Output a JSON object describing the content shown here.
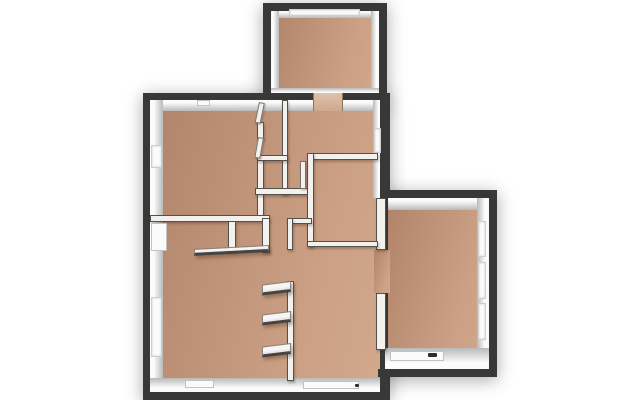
{
  "scene": {
    "description": "3D top-down architectural floor plan render, empty rooms, no text labels",
    "canvas": {
      "width": 640,
      "height": 400
    },
    "colors": {
      "background": "#ffffff",
      "exterior_wall": "#383838",
      "wall_face_highlight": "#fbfbfb",
      "wall_face_shadow": "#b9b9b9",
      "floor_dark": "#b1846a",
      "floor_light": "#cba084",
      "window_recess": "#fbfbfb",
      "interior_wall": "#f3f1ee",
      "wall_edge": "#55504a"
    }
  },
  "plan": {
    "footprints": [
      {
        "name": "footprint-top-room",
        "x": 263,
        "y": 3,
        "w": 124,
        "h": 100
      },
      {
        "name": "footprint-main-block",
        "x": 143,
        "y": 93,
        "w": 247,
        "h": 307
      },
      {
        "name": "footprint-right-wing",
        "x": 378,
        "y": 190,
        "w": 119,
        "h": 187
      }
    ],
    "floors": [
      {
        "name": "floor-top-room",
        "x": 271,
        "y": 10,
        "w": 108,
        "h": 88
      },
      {
        "name": "floor-main-block",
        "x": 150,
        "y": 100,
        "w": 230,
        "h": 292
      },
      {
        "name": "floor-right-wing",
        "x": 388,
        "y": 198,
        "w": 101,
        "h": 171
      },
      {
        "name": "floor-doorway-to-wing",
        "x": 374,
        "y": 250,
        "w": 16,
        "h": 43
      }
    ],
    "faces": [
      {
        "name": "face-top-room-north",
        "x": 271,
        "y": 10,
        "w": 108,
        "h": 8,
        "shade": "d"
      },
      {
        "name": "face-top-room-west",
        "x": 271,
        "y": 10,
        "w": 8,
        "h": 88,
        "shade": "r"
      },
      {
        "name": "face-top-room-east",
        "x": 371,
        "y": 10,
        "w": 8,
        "h": 88,
        "shade": "l"
      },
      {
        "name": "face-top-room-south",
        "x": 271,
        "y": 88,
        "w": 108,
        "h": 6,
        "shade": "u"
      },
      {
        "name": "face-main-north",
        "x": 150,
        "y": 100,
        "w": 230,
        "h": 11,
        "shade": "d"
      },
      {
        "name": "face-main-west",
        "x": 150,
        "y": 100,
        "w": 13,
        "h": 292,
        "shade": "r"
      },
      {
        "name": "face-main-south",
        "x": 150,
        "y": 378,
        "w": 231,
        "h": 14,
        "shade": "u"
      },
      {
        "name": "face-roomC-east",
        "x": 373,
        "y": 100,
        "w": 8,
        "h": 98,
        "shade": "l"
      },
      {
        "name": "face-wing-north",
        "x": 388,
        "y": 198,
        "w": 101,
        "h": 12,
        "shade": "d"
      },
      {
        "name": "face-wing-east",
        "x": 477,
        "y": 198,
        "w": 12,
        "h": 150,
        "shade": "l"
      },
      {
        "name": "face-wing-south",
        "x": 385,
        "y": 348,
        "w": 104,
        "h": 21,
        "shade": "u"
      }
    ],
    "dark_walls": [
      {
        "name": "wall-top-room-north",
        "x": 263,
        "y": 3,
        "w": 124,
        "h": 8
      },
      {
        "name": "wall-top-room-west",
        "x": 263,
        "y": 3,
        "w": 8,
        "h": 97
      },
      {
        "name": "wall-top-room-east",
        "x": 379,
        "y": 3,
        "w": 8,
        "h": 97
      },
      {
        "name": "wall-main-north",
        "x": 143,
        "y": 93,
        "w": 244,
        "h": 7
      },
      {
        "name": "wall-main-west",
        "x": 143,
        "y": 93,
        "w": 7,
        "h": 307
      },
      {
        "name": "wall-main-south",
        "x": 143,
        "y": 392,
        "w": 247,
        "h": 8
      },
      {
        "name": "wall-east-upper",
        "x": 380,
        "y": 93,
        "w": 8,
        "h": 105
      },
      {
        "name": "wall-wing-north",
        "x": 380,
        "y": 190,
        "w": 117,
        "h": 8
      },
      {
        "name": "wall-wing-east",
        "x": 489,
        "y": 190,
        "w": 8,
        "h": 187
      },
      {
        "name": "wall-wing-south",
        "x": 378,
        "y": 369,
        "w": 119,
        "h": 8
      },
      {
        "name": "wall-east-lower",
        "x": 380,
        "y": 369,
        "w": 9,
        "h": 31
      }
    ],
    "windows": [
      {
        "name": "window-top-room",
        "x": 289,
        "y": 9,
        "w": 71,
        "h": 7
      },
      {
        "name": "window-west-upper",
        "x": 151,
        "y": 145,
        "w": 11,
        "h": 23
      },
      {
        "name": "window-west-lower",
        "x": 151,
        "y": 297,
        "w": 11,
        "h": 60
      },
      {
        "name": "window-roomC-east",
        "x": 374,
        "y": 128,
        "w": 7,
        "h": 25
      },
      {
        "name": "window-wing-east-1",
        "x": 478,
        "y": 221,
        "w": 8,
        "h": 36
      },
      {
        "name": "window-wing-east-2",
        "x": 478,
        "y": 262,
        "w": 8,
        "h": 37
      },
      {
        "name": "window-wing-east-3",
        "x": 478,
        "y": 303,
        "w": 8,
        "h": 37
      }
    ],
    "doorways": [
      {
        "name": "doorway-top-room",
        "x": 313,
        "y": 93,
        "w": 30,
        "h": 18
      },
      {
        "name": "doorway-roomD-top",
        "x": 317,
        "y": 154,
        "w": 23,
        "h": 6
      }
    ],
    "interior_walls": [
      {
        "name": "iwall-wing-west-upper",
        "x": 376,
        "y": 198,
        "w": 10,
        "h": 52
      },
      {
        "name": "iwall-wing-west-lower",
        "x": 376,
        "y": 293,
        "w": 10,
        "h": 57
      },
      {
        "name": "iwall-ulroom-east-seg1",
        "x": 257,
        "y": 122,
        "w": 7,
        "h": 18
      },
      {
        "name": "iwall-ulroom-east-seg2",
        "x": 257,
        "y": 157,
        "w": 7,
        "h": 60
      },
      {
        "name": "iwall-ulroom-south",
        "x": 150,
        "y": 215,
        "w": 120,
        "h": 7
      },
      {
        "name": "iwall-wardrobe-post-mid",
        "x": 228,
        "y": 221,
        "w": 8,
        "h": 31
      },
      {
        "name": "iwall-wardrobe-post-right",
        "x": 262,
        "y": 218,
        "w": 8,
        "h": 35
      },
      {
        "name": "iwall-closet-west",
        "x": 282,
        "y": 100,
        "w": 6,
        "h": 95
      },
      {
        "name": "iwall-closet-top",
        "x": 257,
        "y": 155,
        "w": 31,
        "h": 6
      },
      {
        "name": "iwall-hall-north",
        "x": 255,
        "y": 188,
        "w": 55,
        "h": 7
      },
      {
        "name": "iwall-roomD-top",
        "x": 307,
        "y": 153,
        "w": 71,
        "h": 7
      },
      {
        "name": "iwall-roomD-west",
        "x": 307,
        "y": 153,
        "w": 7,
        "h": 94
      },
      {
        "name": "iwall-roomD-south",
        "x": 307,
        "y": 241,
        "w": 71,
        "h": 6
      },
      {
        "name": "iwall-kitchen-top",
        "x": 287,
        "y": 218,
        "w": 25,
        "h": 6
      },
      {
        "name": "iwall-kitchen-west",
        "x": 287,
        "y": 218,
        "w": 6,
        "h": 32
      },
      {
        "name": "iwall-closet-run-south",
        "x": 287,
        "y": 281,
        "w": 7,
        "h": 100
      }
    ],
    "thresholds": [
      {
        "name": "entry-door-west",
        "x": 151,
        "y": 223,
        "w": 16,
        "h": 28
      },
      {
        "name": "sill-south-left",
        "x": 185,
        "y": 380,
        "w": 29,
        "h": 8
      },
      {
        "name": "sill-south-middle",
        "x": 303,
        "y": 381,
        "w": 56,
        "h": 8
      },
      {
        "name": "sill-wing-south",
        "x": 390,
        "y": 351,
        "w": 54,
        "h": 10
      },
      {
        "name": "sill-north-small",
        "x": 197,
        "y": 100,
        "w": 13,
        "h": 6
      }
    ],
    "door_leaves": [
      {
        "name": "door-leaf-ulroom-1",
        "x": 259,
        "y": 102,
        "w": 6,
        "h": 21,
        "rot": 12
      },
      {
        "name": "door-leaf-ulroom-2",
        "x": 258,
        "y": 137,
        "w": 6,
        "h": 21,
        "rot": 10
      },
      {
        "name": "door-leaf-roomD",
        "x": 300,
        "y": 161,
        "w": 6,
        "h": 28,
        "rot": 0
      }
    ],
    "shelves": [
      {
        "name": "wardrobe-shelf",
        "x": 194,
        "y": 245,
        "w": 75,
        "h": 7,
        "skew": -3
      },
      {
        "name": "closet-door-slab-1",
        "x": 262,
        "y": 281,
        "w": 29,
        "h": 11,
        "skew": -7
      },
      {
        "name": "closet-door-slab-2",
        "x": 262,
        "y": 311,
        "w": 29,
        "h": 11,
        "skew": -7
      },
      {
        "name": "closet-door-slab-3",
        "x": 262,
        "y": 343,
        "w": 29,
        "h": 11,
        "skew": -7
      }
    ],
    "marks": [
      {
        "name": "handle-mark-south-sill",
        "x": 355,
        "y": 384,
        "w": 4,
        "h": 3
      },
      {
        "name": "handle-mark-wing-sill",
        "x": 428,
        "y": 353,
        "w": 9,
        "h": 4
      }
    ]
  }
}
